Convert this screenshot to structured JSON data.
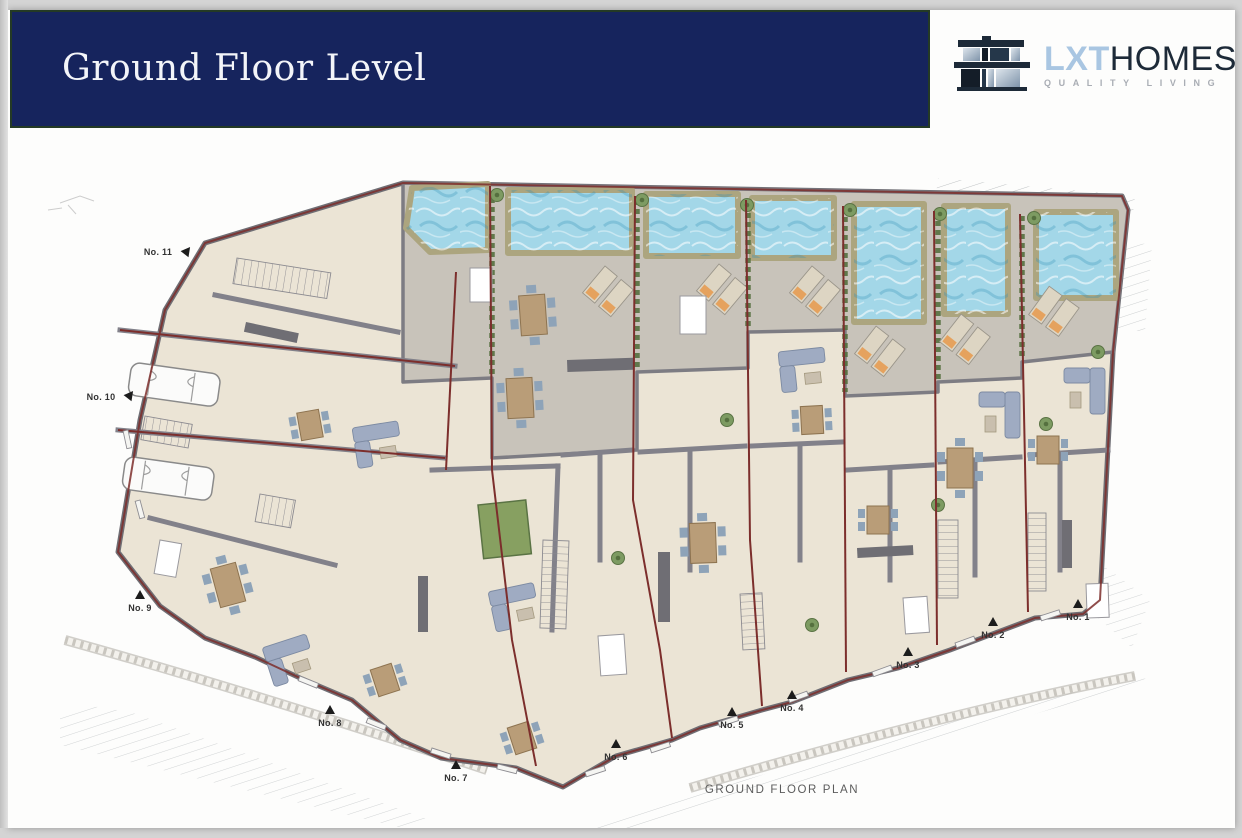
{
  "header": {
    "title": "Ground Floor Level"
  },
  "logo": {
    "lxt": "LXT",
    "homes": "HOMES",
    "tagline": "QUALITY LIVING"
  },
  "plan": {
    "caption": "GROUND FLOOR PLAN",
    "units": [
      {
        "label": "No. 1"
      },
      {
        "label": "No. 2"
      },
      {
        "label": "No. 3"
      },
      {
        "label": "No. 4"
      },
      {
        "label": "No. 5"
      },
      {
        "label": "No. 6"
      },
      {
        "label": "No. 7"
      },
      {
        "label": "No. 8"
      },
      {
        "label": "No. 9"
      },
      {
        "label": "No. 10"
      },
      {
        "label": "No. 11"
      }
    ]
  },
  "colors": {
    "header_navy": "#16245d",
    "header_border_green": "#243a25",
    "logo_light_blue": "#a9c6e2",
    "logo_dark": "#1d2a38",
    "pool_blue": "#a3d7e8",
    "boundary_red": "#7c2e2c",
    "floor_cream": "#ebe4d5",
    "terrace_grey": "#c8c3ba",
    "wall_grey": "#77767c"
  }
}
